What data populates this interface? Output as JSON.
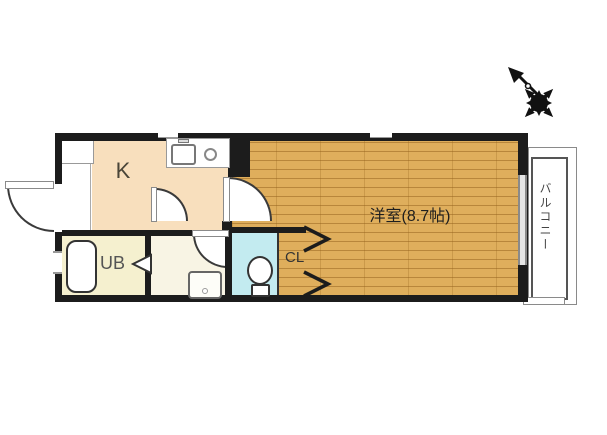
{
  "floor_plan": {
    "kitchen": {
      "label": "K"
    },
    "unit_bath": {
      "label": "UB"
    },
    "closet": {
      "label": "CL"
    },
    "western_room": {
      "label": "洋室(8.7帖)"
    },
    "balcony": {
      "label": "バルコニー"
    },
    "colors": {
      "wall": "#1c1c1c",
      "kitchen_floor": "#f8dfbd",
      "unit_bath_floor": "#f5f0cf",
      "washroom_floor": "#f8f4e4",
      "toilet_floor": "#c3ebf0",
      "wood_floor": "#dfae5c",
      "wood_plank_line": "#b8863b",
      "balcony_line": "#888888"
    },
    "icons": {
      "compass": "north-arrow-compass-rose",
      "kitchen_sink": "sink-with-faucet",
      "stove": "single-burner",
      "bath": "bathtub",
      "toilet": "toilet",
      "laundry": "washing-machine",
      "closet_doors": "double-chevron-folding-doors",
      "bath_door": "left-triangle-folding-door"
    }
  }
}
